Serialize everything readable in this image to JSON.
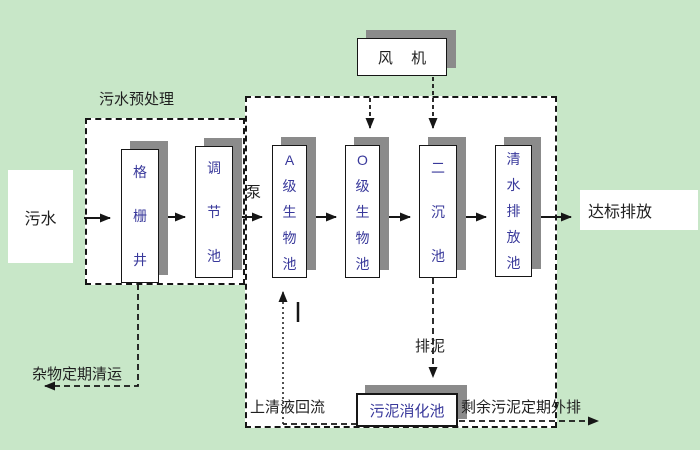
{
  "colors": {
    "bg": "#c8e7c8",
    "shadow": "#8b8b8b",
    "boxtext": "#39399b",
    "label": "#1f1f1f",
    "line": "#161616",
    "fill": "#ffffff"
  },
  "diagram": {
    "nodes": {
      "influent": "污水",
      "grid_well": "格栅井",
      "equalization_tank": "调节池",
      "a_bio_tank": "A级生物池",
      "o_bio_tank": "O级生物池",
      "secondary_clarifier": "二沉池",
      "clear_water_tank": "清水排放池",
      "blower": "风 机",
      "sludge_digester": "污泥消化池",
      "effluent": "达标排放"
    },
    "labels": {
      "pretreatment": "污水预处理",
      "pump": "泵",
      "debris_removal": "杂物定期清运",
      "supernatant_return": "上清液回流",
      "sludge_discharge": "排泥",
      "excess_sludge_out": "剩余污泥定期外排"
    }
  }
}
